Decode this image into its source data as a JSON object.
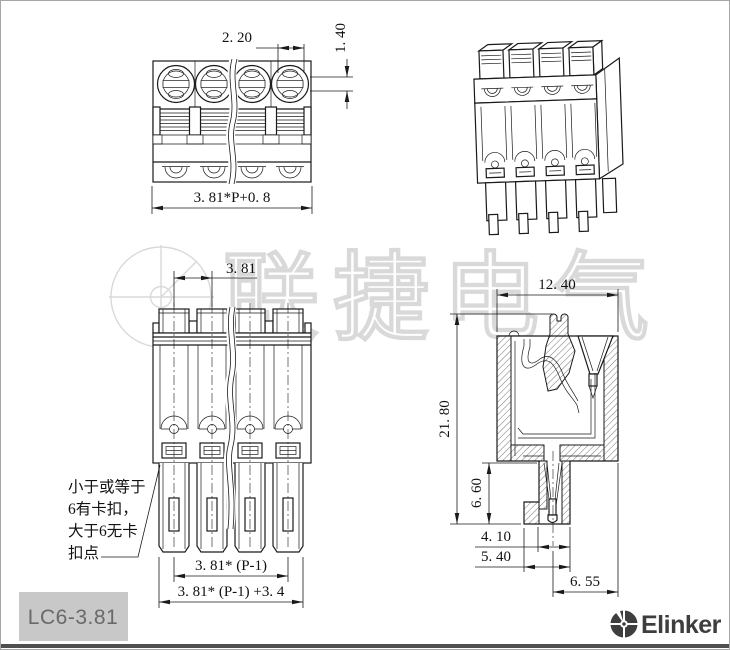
{
  "product": {
    "model": "LC6-3.81",
    "brand": "Elinker",
    "watermark": "联捷电气"
  },
  "note": {
    "line1": "小于或等于",
    "line2": "6有卡扣，",
    "line3": "大于6无卡",
    "line4": "扣点"
  },
  "dims": {
    "top_view": {
      "slot_pitch": "2. 20",
      "slot_width": "1. 40",
      "total_width": "3. 81*P+0. 8"
    },
    "front_view": {
      "pitch": "3. 81",
      "pole_span": "3. 81* (P-1)",
      "total_width": "3. 81* (P-1) +3. 4"
    },
    "section_view": {
      "width": "12. 40",
      "height": "21. 80",
      "pin_length": "6. 60",
      "pin_offset": "4. 10",
      "base_width": "5. 40",
      "depth": "6. 55"
    }
  },
  "colors": {
    "line": "#1a1a1a",
    "watermark": "#d9d9d9",
    "label_bg": "#c8c8c8",
    "logo": "#3e3e3e"
  }
}
